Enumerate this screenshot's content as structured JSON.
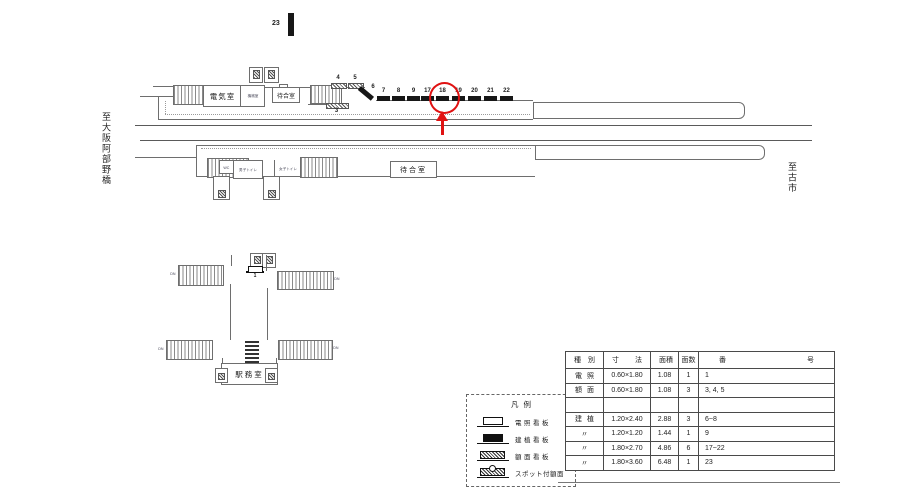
{
  "colors": {
    "highlight_red": "#e01212",
    "line_gray": "#6e6e6e",
    "bar_black": "#171717"
  },
  "directions": {
    "left": "至大阪阿部野橋",
    "right": "至古市"
  },
  "signs": {
    "sign23": "23",
    "sign1": "1",
    "sign3": "3",
    "sign4": "4",
    "sign5": "5",
    "sign6": "6",
    "black_signs": [
      "7",
      "8",
      "9",
      "17",
      "18",
      "19",
      "20",
      "21",
      "22"
    ],
    "highlighted": "18"
  },
  "upper_platform": {
    "electric_room": "電気室",
    "machine_room": "機械室",
    "waiting_room": "待合室"
  },
  "lower_platform": {
    "wc": "WC",
    "mens_toilet": "男子トイレ",
    "womens_toilet": "女子トイレ",
    "waiting_room": "待合室"
  },
  "concourse": {
    "office": "駅務室",
    "down_label": "DN"
  },
  "legend": {
    "title": "凡例",
    "items": [
      {
        "symbol": "denshou",
        "label": "電照看板"
      },
      {
        "symbol": "kenshoku",
        "label": "建植看板"
      },
      {
        "symbol": "gakumen",
        "label": "額面看板"
      },
      {
        "symbol": "spot",
        "label": "スポット付額面"
      }
    ]
  },
  "table": {
    "headers": [
      "種別",
      "寸法",
      "面積",
      "面数",
      "番号"
    ],
    "rows": [
      [
        "電照",
        "0.60×1.80",
        "1.08",
        "1",
        "1"
      ],
      [
        "額面",
        "0.60×1.80",
        "1.08",
        "3",
        "3, 4, 5"
      ],
      [
        "",
        "",
        "",
        "",
        ""
      ],
      [
        "建植",
        "1.20×2.40",
        "2.88",
        "3",
        "6~8"
      ],
      [
        "〃",
        "1.20×1.20",
        "1.44",
        "1",
        "9"
      ],
      [
        "〃",
        "1.80×2.70",
        "4.86",
        "6",
        "17~22"
      ],
      [
        "〃",
        "1.80×3.60",
        "6.48",
        "1",
        "23"
      ]
    ]
  }
}
